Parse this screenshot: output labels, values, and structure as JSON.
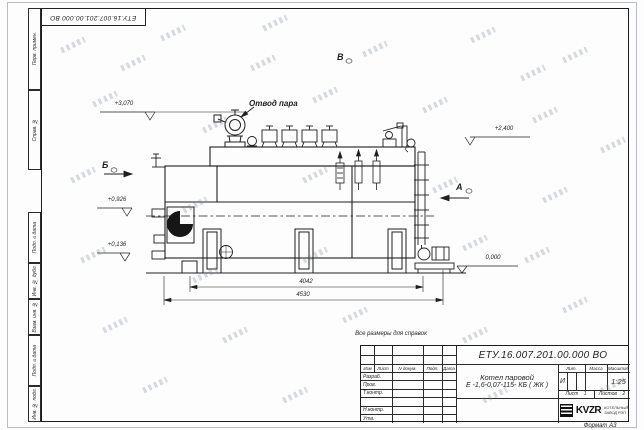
{
  "designation": "ЕТУ.16.007.201.00.000  ВО",
  "sheet": {
    "format_label": "Формат А3",
    "reference_note": "Все размеры для справок"
  },
  "margin_columns": {
    "perv_primen": "Перв. примен.",
    "sprav_no": "Справ. №",
    "podp_data": "Подп. и дата",
    "inv_dubl": "Инв. № дубл.",
    "vzam_inv": "Взам. инв. №",
    "inv_podl": "Инв. № подл."
  },
  "drawing": {
    "steam_outlet_label": "Отвод пара",
    "view_labels": {
      "a": "А",
      "b": "Б",
      "v": "В"
    },
    "elevation_marks": {
      "valve_top": "+3,070",
      "drum_top": "+2,400",
      "burner_axis": "+0,926",
      "grate": "+0,136",
      "floor": "0,000"
    },
    "dimensions": {
      "support_span": "4042",
      "overall_length": "4530"
    }
  },
  "title_block": {
    "product_name_line1": "Котел паровой",
    "product_name_line2": "Е -1,6-0,07-115- КБ ( ЖК )",
    "table_headers": {
      "izm": "Изм",
      "list": "Лист",
      "doc": "N докум.",
      "podp": "Подп.",
      "data": "Дата"
    },
    "signature_rows": {
      "razrab": "Разраб.",
      "prov": "Пров.",
      "t_kontr": "Т.контр.",
      "n_kontr": "Н.контр.",
      "utv": "Утв."
    },
    "lit": {
      "header": "Лит.",
      "value": "И"
    },
    "massa": {
      "header": "Масса",
      "value": ""
    },
    "masshtab": {
      "header": "Масштаб",
      "value": "1:25"
    },
    "sheet": {
      "label": "Лист",
      "value": "1"
    },
    "sheets": {
      "label": "Листов",
      "value": "2"
    },
    "logo": {
      "abbr": "KVZR",
      "line1": "КОТЕЛЬНЫЙ",
      "line2": "ЗАВОД РЭП"
    }
  },
  "colors": {
    "ink": "#1f1f1f",
    "frame": "#1c1c1c",
    "watermark": "#aeb6c2"
  }
}
